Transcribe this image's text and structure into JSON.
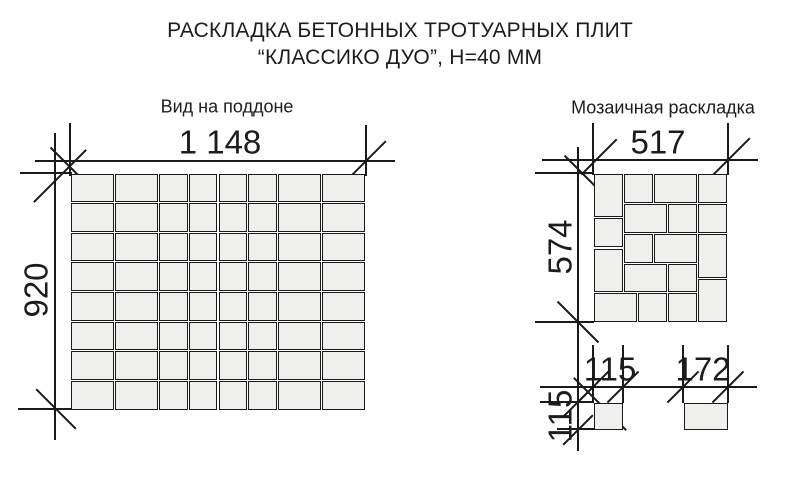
{
  "title": {
    "line1": "РАСКЛАДКА БЕТОННЫХ ТРОТУАРНЫХ ПЛИТ",
    "line2": "“КЛАССИКО ДУО”, Н=40 ММ"
  },
  "colors": {
    "background": "#ffffff",
    "line": "#1a1a1a",
    "text": "#1c1c1c",
    "tile_fill": "#efefee"
  },
  "pallet_view": {
    "label": "Вид на поддоне",
    "width_label": "1 148",
    "height_label": "920",
    "width_mm": 1148,
    "height_mm": 920,
    "columns_mm": [
      172,
      172,
      115,
      115,
      115,
      115,
      172,
      172
    ],
    "rows_mm": [
      115,
      115,
      115,
      115,
      115,
      115,
      115,
      115
    ]
  },
  "mosaic_view": {
    "label": "Мозаичная раскладка",
    "width_label": "517",
    "height_label": "574",
    "width_mm": 517,
    "height_mm": 574,
    "tiles_mm": [
      {
        "x": 0,
        "y": 0,
        "w": 115,
        "h": 172
      },
      {
        "x": 115,
        "y": 0,
        "w": 115,
        "h": 115
      },
      {
        "x": 230,
        "y": 0,
        "w": 172,
        "h": 115
      },
      {
        "x": 402,
        "y": 0,
        "w": 115,
        "h": 115
      },
      {
        "x": 0,
        "y": 172,
        "w": 115,
        "h": 115
      },
      {
        "x": 115,
        "y": 115,
        "w": 172,
        "h": 115
      },
      {
        "x": 287,
        "y": 115,
        "w": 115,
        "h": 115
      },
      {
        "x": 402,
        "y": 115,
        "w": 115,
        "h": 115
      },
      {
        "x": 115,
        "y": 230,
        "w": 115,
        "h": 115
      },
      {
        "x": 230,
        "y": 230,
        "w": 172,
        "h": 115
      },
      {
        "x": 402,
        "y": 230,
        "w": 115,
        "h": 172
      },
      {
        "x": 0,
        "y": 287,
        "w": 115,
        "h": 172
      },
      {
        "x": 115,
        "y": 345,
        "w": 172,
        "h": 114
      },
      {
        "x": 287,
        "y": 345,
        "w": 115,
        "h": 114
      },
      {
        "x": 0,
        "y": 459,
        "w": 172,
        "h": 115
      },
      {
        "x": 172,
        "y": 459,
        "w": 115,
        "h": 115
      },
      {
        "x": 287,
        "y": 459,
        "w": 115,
        "h": 115
      },
      {
        "x": 402,
        "y": 402,
        "w": 115,
        "h": 172
      }
    ]
  },
  "single_tiles": {
    "square": {
      "width_label": "115",
      "height_label": "115",
      "width_mm": 115,
      "height_mm": 115
    },
    "rect": {
      "width_label": "172",
      "width_mm": 172,
      "height_mm": 115
    }
  }
}
